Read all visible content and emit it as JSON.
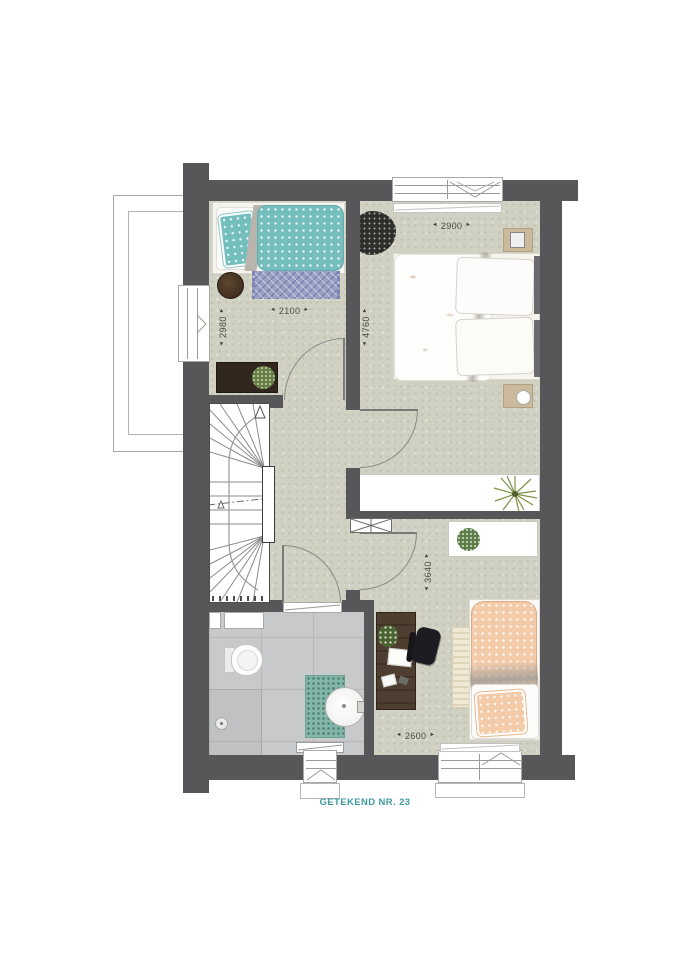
{
  "footer": {
    "label": "GETEKEND NR. 23"
  },
  "icons": {
    "arrow_start": "◄",
    "arrow_end": "►"
  },
  "dims": {
    "teal_room_width": {
      "value": "2100"
    },
    "teal_room_depth": {
      "value": "2980"
    },
    "master_room_width": {
      "value": "2900"
    },
    "master_room_depth": {
      "value": "4760"
    },
    "back_room_depth": {
      "value": "3640"
    },
    "back_room_width": {
      "value": "2600"
    }
  },
  "colors": {
    "wall": "#57575a",
    "floor": "#d0d1c3",
    "bathroom_floor": "#c8c9cb",
    "accent_teal": "#3f9ba0",
    "bed_teal": "#74bfbe",
    "bed_orange": "#f3cba9",
    "rug_blue": "#98a0c4",
    "dimension_text": "#4a4a48"
  }
}
